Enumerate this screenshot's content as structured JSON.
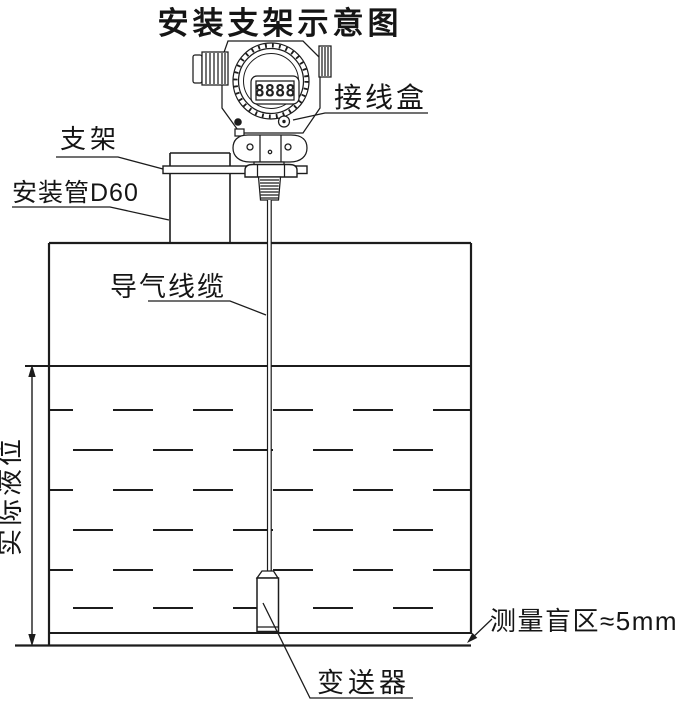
{
  "diagram": {
    "title": "安装支架示意图",
    "labels": {
      "junction_box": "接线盒",
      "bracket": "支架",
      "mounting_pipe": "安装管D60",
      "air_cable": "导气线缆",
      "actual_level": "实际液位",
      "blind_zone": "测量盲区≈5mm",
      "transmitter": "变送器"
    },
    "device": {
      "lcd_reading": "8888"
    },
    "colors": {
      "line": "#1c1c1c",
      "background": "#ffffff"
    }
  }
}
